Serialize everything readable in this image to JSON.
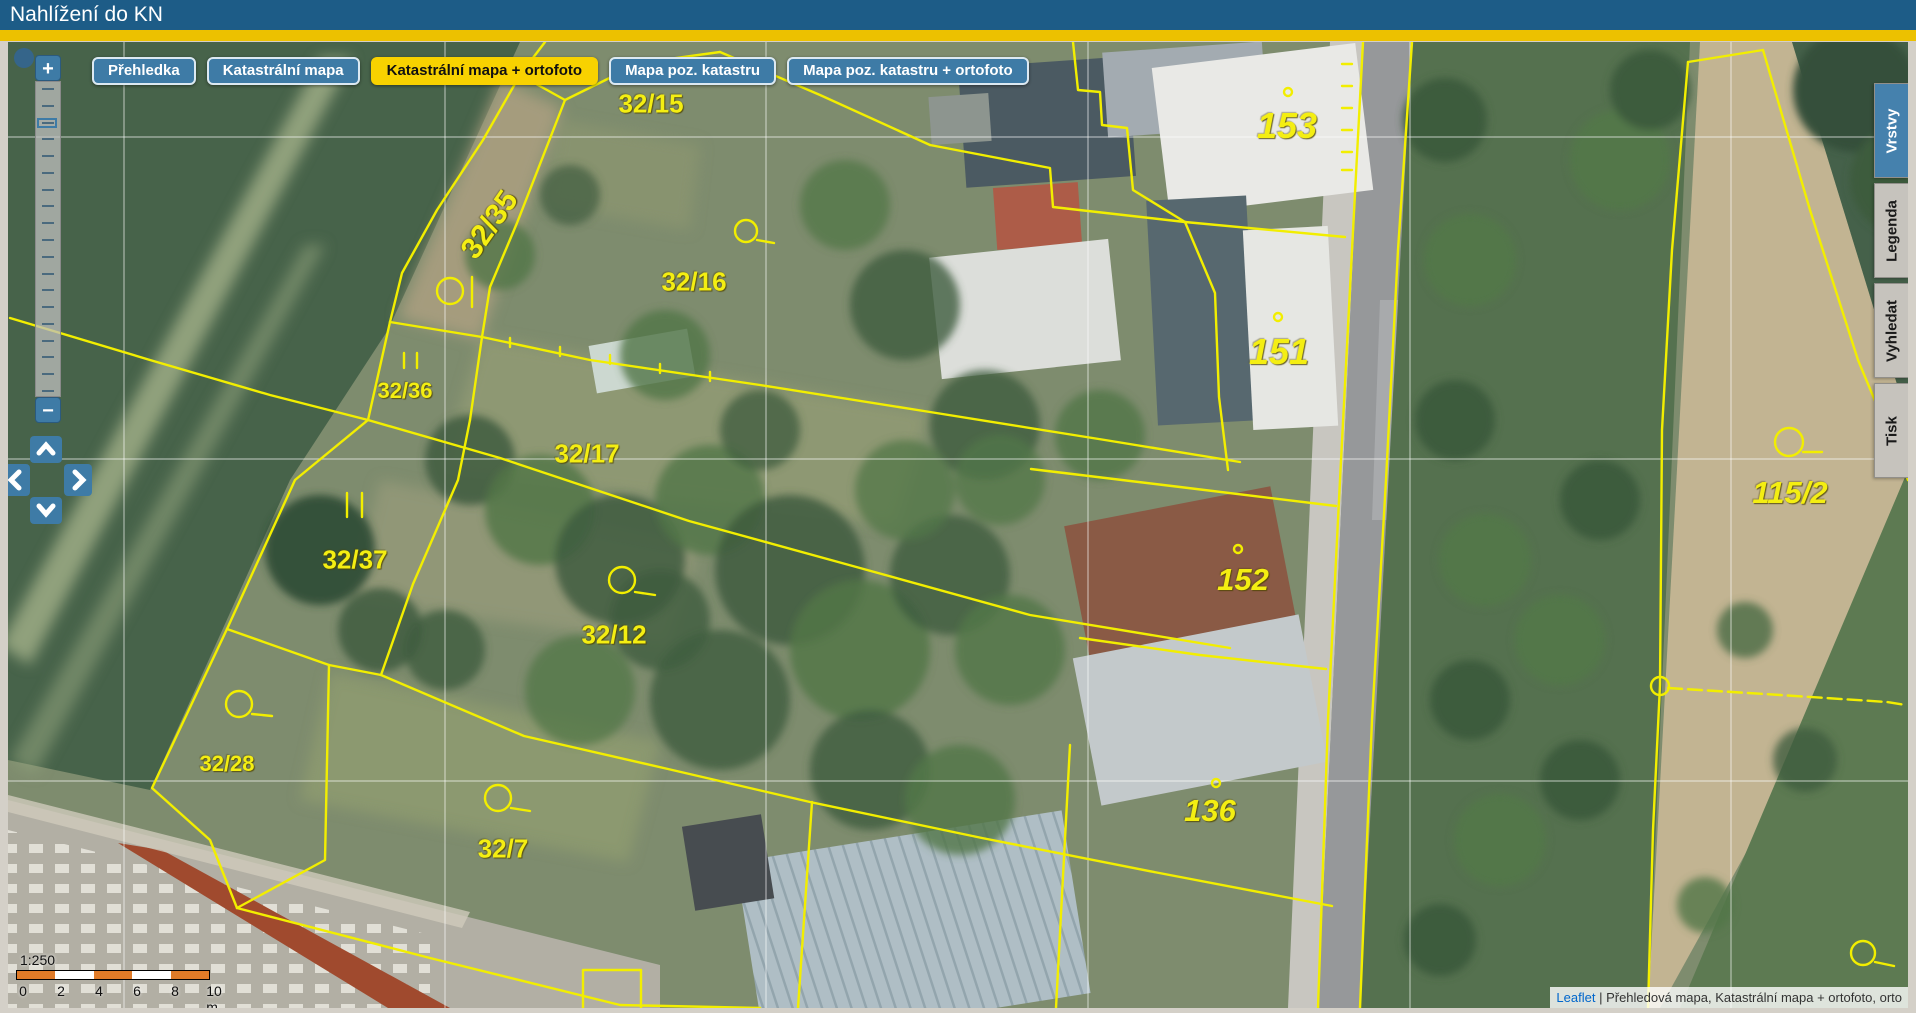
{
  "header": {
    "title": "Nahlížení do KN"
  },
  "toolbar": {
    "buttons": [
      {
        "label": "Přehledka",
        "active": false
      },
      {
        "label": "Katastrální mapa",
        "active": false
      },
      {
        "label": "Katastrální mapa + ortofoto",
        "active": true
      },
      {
        "label": "Mapa poz. katastru",
        "active": false
      },
      {
        "label": "Mapa poz. katastru + ortofoto",
        "active": false
      }
    ]
  },
  "side_tabs": [
    {
      "label": "Vrstvy",
      "active": true
    },
    {
      "label": "Legenda",
      "active": false
    },
    {
      "label": "Vyhledat",
      "active": false
    },
    {
      "label": "Tisk",
      "active": false
    }
  ],
  "zoom_control": {
    "zoom_in_label": "+",
    "zoom_out_label": "−",
    "levels": 19,
    "active_level": 2
  },
  "map": {
    "parcels": [
      {
        "label": "32/15"
      },
      {
        "label": "32/35"
      },
      {
        "label": "32/16"
      },
      {
        "label": "153"
      },
      {
        "label": "151"
      },
      {
        "label": "32/36"
      },
      {
        "label": "32/17"
      },
      {
        "label": "32/37"
      },
      {
        "label": "32/12"
      },
      {
        "label": "115/2"
      },
      {
        "label": "152"
      },
      {
        "label": "32/28"
      },
      {
        "label": "32/7"
      },
      {
        "label": "136"
      }
    ],
    "scale": {
      "ratio": "1:250",
      "ticks": [
        "0",
        "2",
        "4",
        "6",
        "8",
        "10 m"
      ]
    },
    "attribution": {
      "link": "Leaflet",
      "separator": " | ",
      "layers": "Přehledová mapa, Katastrální mapa + ortofoto, orto"
    }
  },
  "colors": {
    "header_blue": "#1d5c87",
    "gold_stripe": "#ecc100",
    "button_blue": "#3e7ba6",
    "active_yellow": "#f8d200",
    "parcel_line_yellow": "#f2ee00",
    "scale_orange": "#e07b28"
  }
}
